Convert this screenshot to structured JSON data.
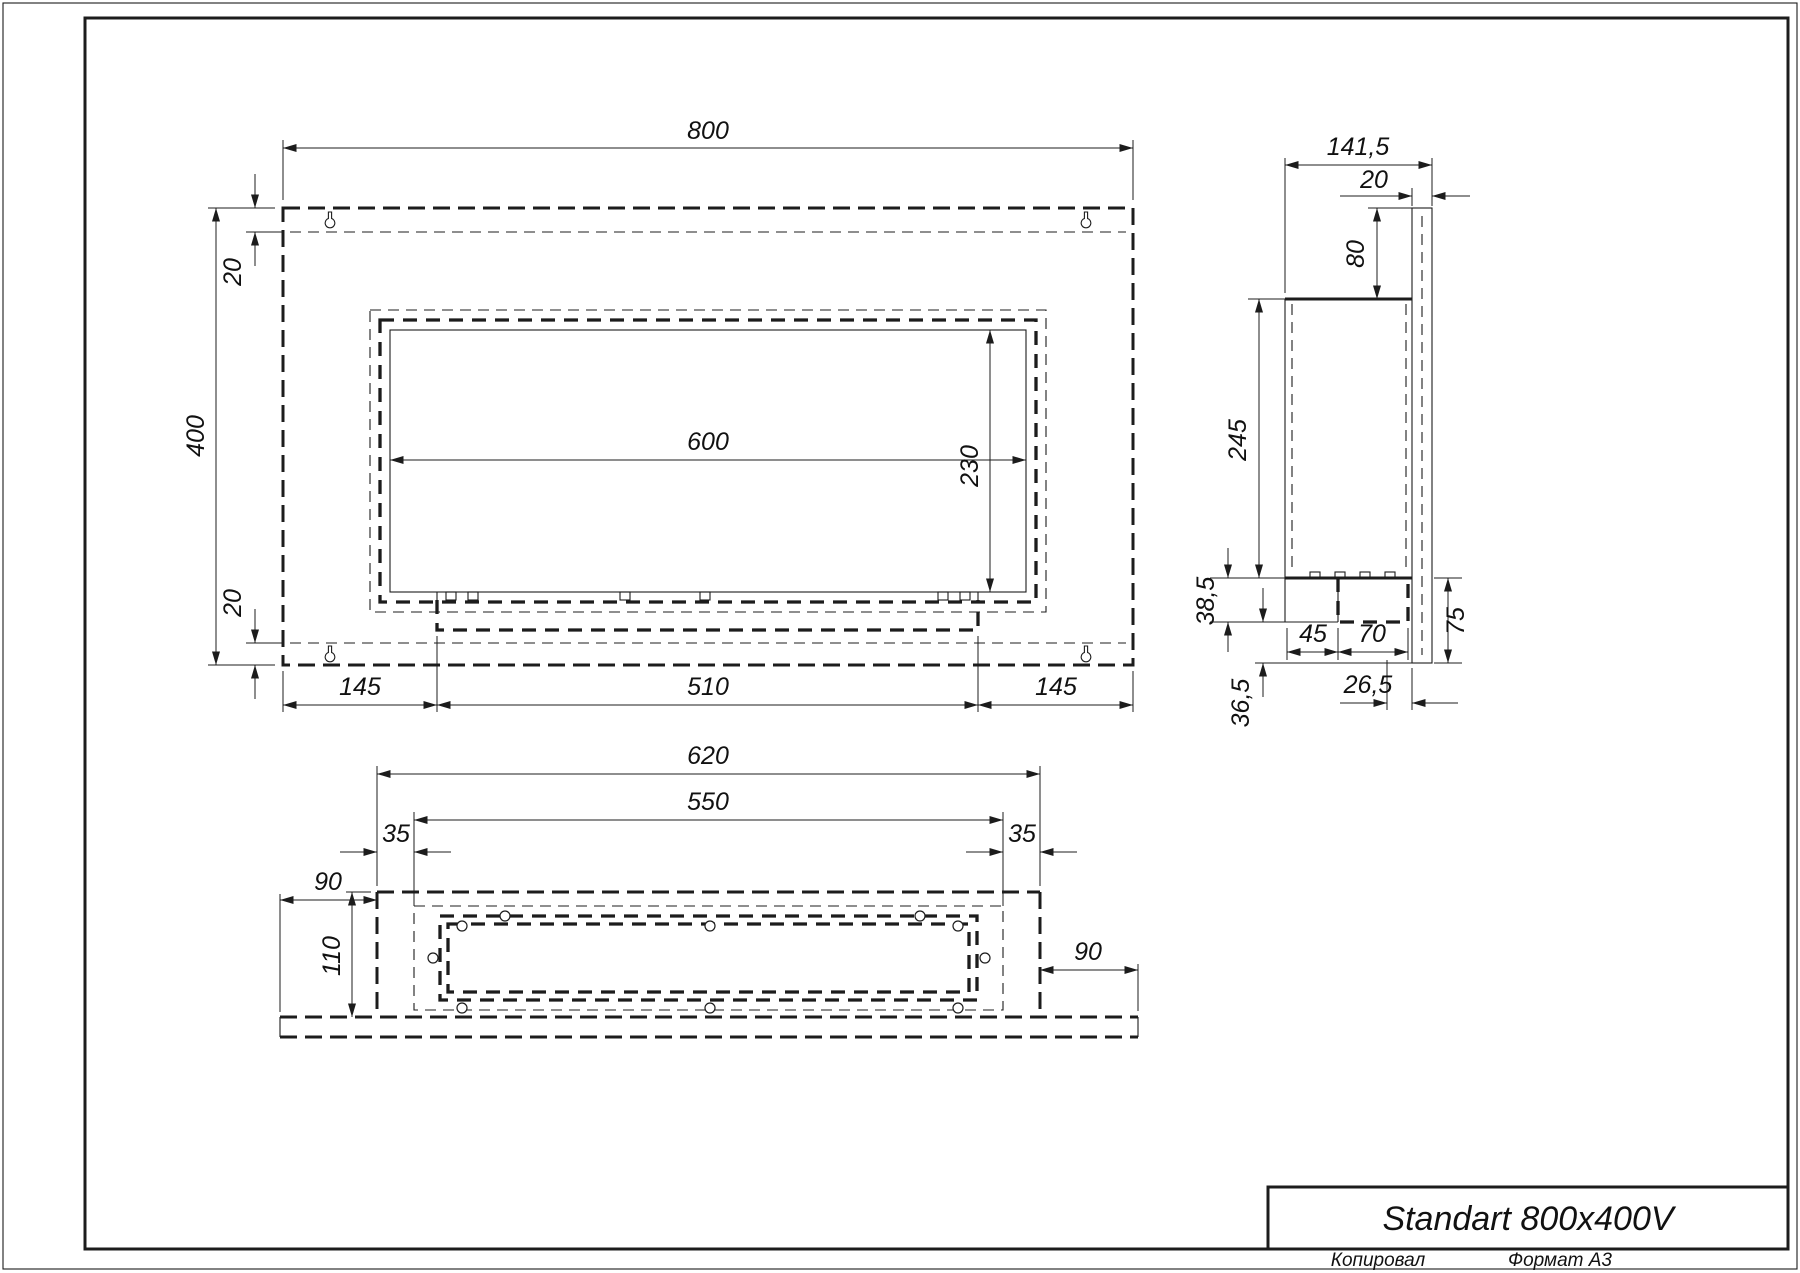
{
  "drawing": {
    "title": "Standart 800x400V",
    "footer": {
      "copied": "Копировал",
      "format": "Формат А3"
    },
    "views": {
      "front": {
        "width": "800",
        "height": "400",
        "top_inset": "20",
        "bottom_inset": "20",
        "opening_width": "600",
        "opening_height": "230",
        "left_margin": "145",
        "burner_width": "510",
        "right_margin": "145"
      },
      "side": {
        "depth": "141,5",
        "panel_thickness": "20",
        "top_to_box": "80",
        "box_height": "245",
        "tray_height": "38,5",
        "tray_left": "45",
        "burner_depth": "70",
        "panel_below": "75",
        "front_offset": "26,5",
        "bottom_offset": "36,5"
      },
      "bottom": {
        "body_width": "620",
        "inner_width": "550",
        "left_inset": "35",
        "right_inset": "35",
        "flange_left": "90",
        "depth": "110",
        "flange_right": "90"
      }
    }
  }
}
